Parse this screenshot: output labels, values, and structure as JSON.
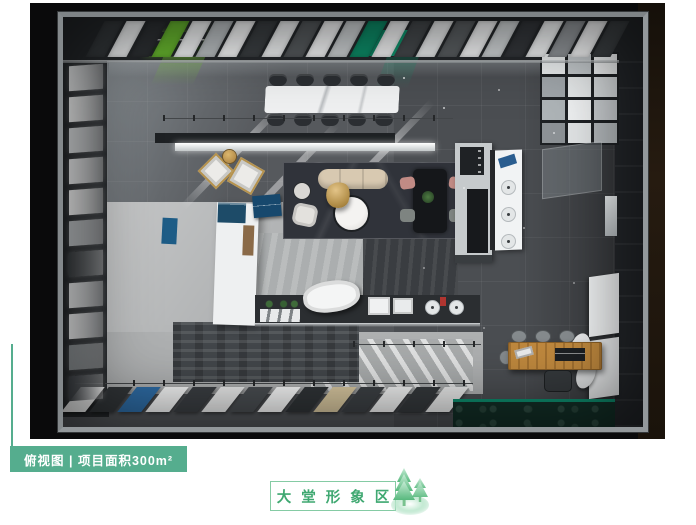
{
  "view_annotation": {
    "label_text": "俯视图 | 项目面积300m²",
    "accent_color": "#55ad8e"
  },
  "caption": {
    "text": "大堂形象区",
    "text_color": "#3fa871",
    "border_color": "#85cba4",
    "tree_icon": "pine-trees-on-hill"
  },
  "scene": {
    "description": "大堂形象区 俯视渲染图 (top-down rendering of 300m² lobby showroom)",
    "colors": {
      "backdrop": "#0a0a0b",
      "floor_dark": "#4b4e52",
      "floor_light": "#b2b4b5",
      "ceiling_sign_green": "#63b22c",
      "ceiling_panel_teal": "#0d8a66",
      "entrance_mat_green": "#132f27",
      "wood_table": "#c0893e",
      "platform_marble": "#30333a"
    }
  }
}
